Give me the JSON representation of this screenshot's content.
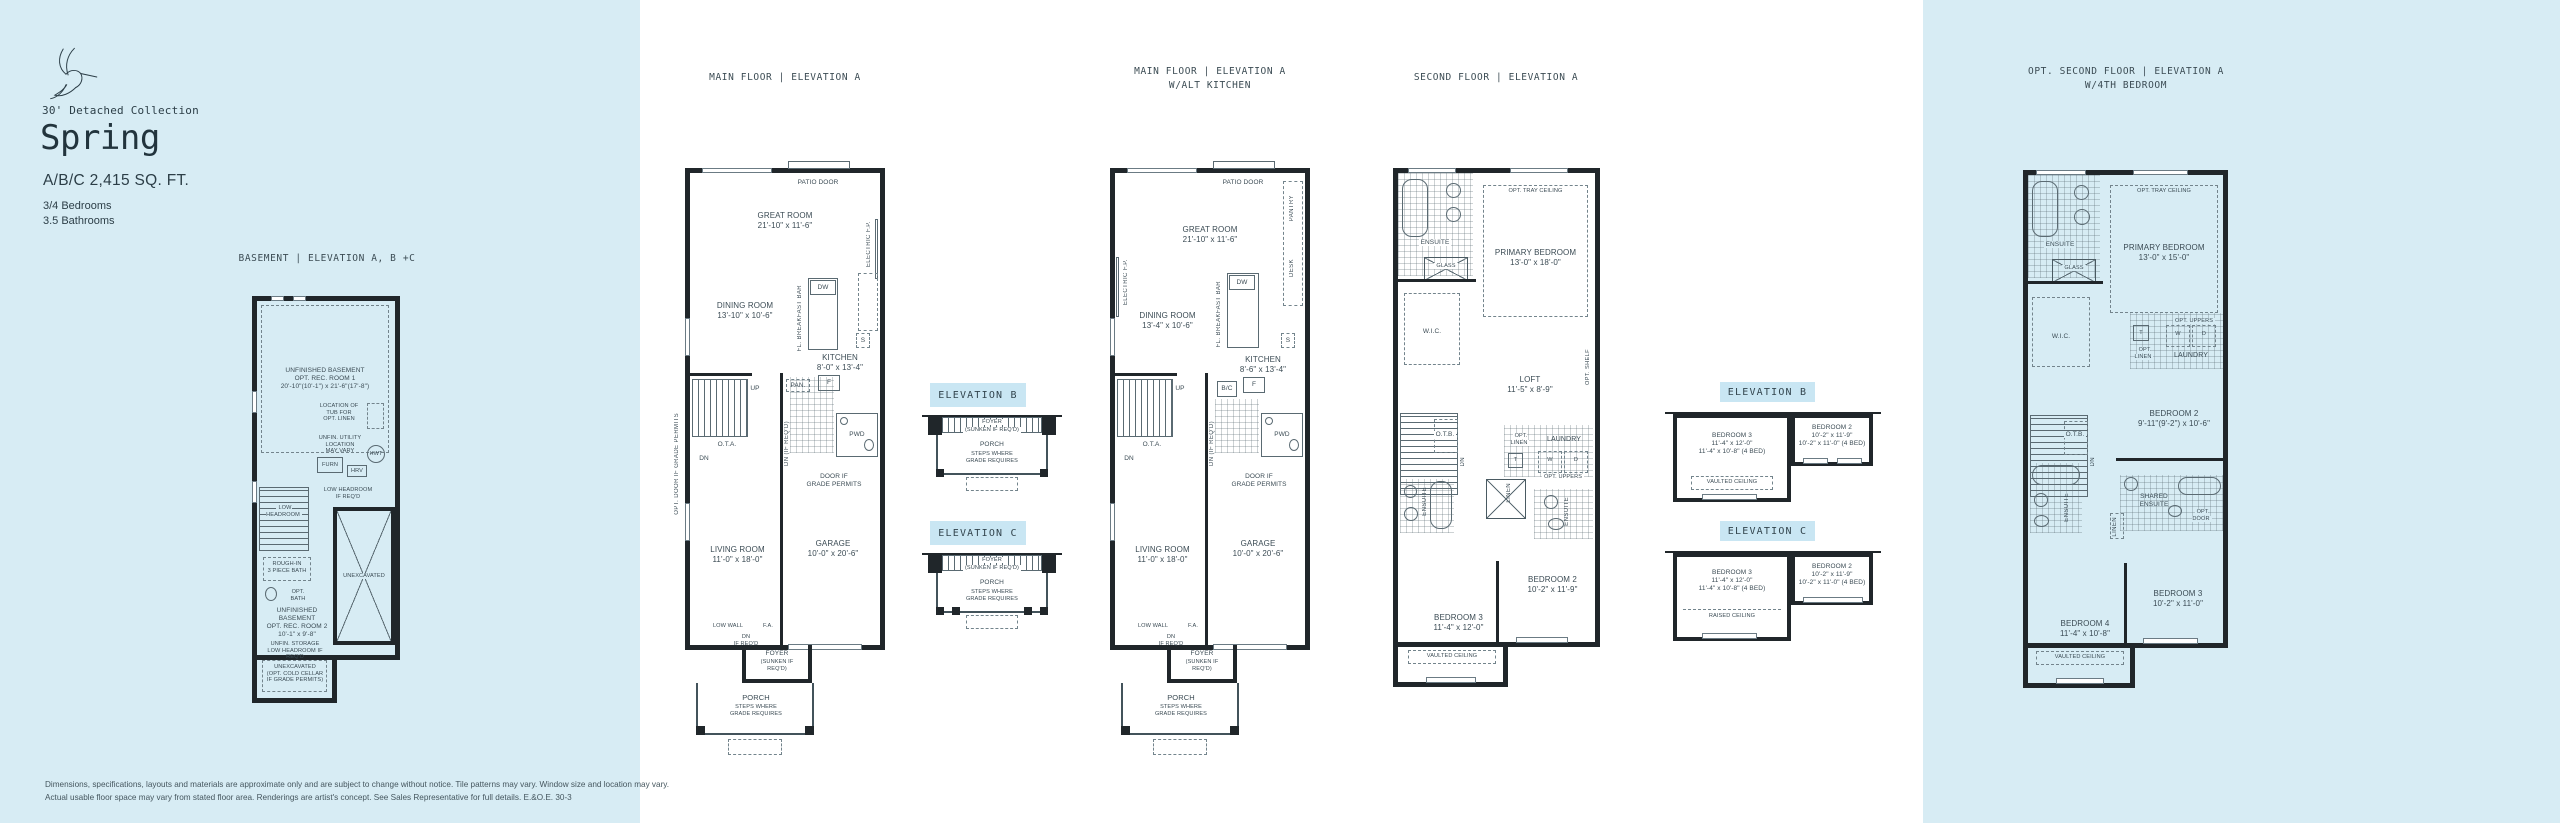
{
  "colors": {
    "panel_blue": "#d7ecf4",
    "badge_blue": "#c9e6f3",
    "wall": "#20262a",
    "line": "#5a6a72",
    "text": "#2c3e47"
  },
  "brand": {
    "collection": "30' Detached Collection",
    "model": "Spring",
    "size": "A/B/C 2,415 SQ. FT.",
    "beds": "3/4 Bedrooms",
    "baths": "3.5 Bathrooms"
  },
  "titles": {
    "basement": "BASEMENT  |  ELEVATION A, B +C",
    "main_a": "MAIN FLOOR  |  ELEVATION A",
    "main_alt_line1": "MAIN FLOOR  |  ELEVATION A",
    "main_alt_line2": "W/ALT KITCHEN",
    "second": "SECOND FLOOR  |  ELEVATION A",
    "opt_line1": "OPT. SECOND FLOOR  |  ELEVATION A",
    "opt_line2": "W/4TH BEDROOM",
    "elev_b": "ELEVATION B",
    "elev_c": "ELEVATION C"
  },
  "basement": {
    "rec1": "UNFINISHED BASEMENT\nOPT. REC. ROOM 1\n20'-10\"(10'-1\") x 21'-6\"(17'-8\")",
    "tub_note": "LOCATION OF\nTUB FOR\nOPT. LINEN",
    "utility": "UNFIN. UTILITY\nLOCATION\nMAY VARY",
    "furn": "FURN",
    "hrv": "HRV",
    "hwt": "HWT",
    "low_headroom_req": "LOW HEADROOM\nIF REQ'D",
    "low_headroom": "LOW HEADROOM",
    "rough_in": "ROUGH-IN\n3 PIECE BATH",
    "opt_bath": "OPT.\nBATH",
    "rec2": "UNFINISHED\nBASEMENT\nOPT. REC. ROOM 2\n10'-1\" x 9'-8\"",
    "unexcavated": "UNEXCAVATED",
    "storage": "UNFIN. STORAGE\nLOW HEADROOM IF REQ'D",
    "cold_cellar": "UNEXCAVATED\n(OPT. COLD CELLAR\nIF GRADE PERMITS)"
  },
  "main_a": {
    "patio_door": "PATIO DOOR",
    "great_room": "GREAT ROOM\n21'-10\" x 11'-6\"",
    "electric_fp": "ELECTRIC F.P.",
    "dining": "DINING ROOM\n13'-10\" x 10'-6\"",
    "breakfast_bar": "FL. BREAKFAST BAR",
    "dw": "DW",
    "kitchen": "KITCHEN\n8'-0\" x 13'-4\"",
    "pan": "PAN.",
    "s": "S",
    "f": "F",
    "ota": "O.T.A.",
    "up": "UP",
    "dn": "DN",
    "pwd": "PWD",
    "dn_if_reqd": "DN (IF REQ'D)",
    "door_grade": "DOOR IF\nGRADE PERMITS",
    "opt_door_grade": "OPT. DOOR IF GRADE PERMITS",
    "living": "LIVING ROOM\n11'-0\" x 18'-0\"",
    "garage": "GARAGE\n10'-0\" x 20'-6\"",
    "low_wall": "LOW WALL",
    "fa": "F.A.",
    "dn_if_reqd2": "DN\nIF REQ'D",
    "foyer": "FOYER",
    "foyer_note": "(SUNKEN IF\nREQ'D)",
    "porch": "PORCH",
    "porch_note": "STEPS WHERE\nGRADE REQUIRES"
  },
  "main_alt": {
    "patio_door": "PATIO DOOR",
    "pantry": "PANTRY",
    "desk": "DESK",
    "great_room": "GREAT ROOM\n21'-10\" x 11'-6\"",
    "electric_fp": "ELECTRIC F.P.",
    "dining": "DINING ROOM\n13'-4\" x 10'-6\"",
    "breakfast_bar": "FL. BREAKFAST BAR",
    "dw": "DW",
    "kitchen": "KITCHEN\n8'-6\" x 13'-4\"",
    "bc": "B/C",
    "f": "F",
    "s": "S",
    "ota": "O.T.A.",
    "up": "UP",
    "dn": "DN",
    "pwd": "PWD",
    "dn_if_reqd": "DN (IF REQ'D)",
    "door_grade": "DOOR IF\nGRADE PERMITS",
    "living": "LIVING ROOM\n11'-0\" x 18'-0\"",
    "garage": "GARAGE\n10'-0\" x 20'-6\"",
    "low_wall": "LOW WALL",
    "fa": "F.A.",
    "dn_if_reqd2": "DN\nIF REQ'D",
    "foyer": "FOYER",
    "foyer_note": "(SUNKEN IF\nREQ'D)",
    "porch": "PORCH",
    "porch_note": "STEPS WHERE\nGRADE REQUIRES"
  },
  "second": {
    "ensuite": "ENSUITE",
    "glass": "GLASS",
    "tray": "OPT. TRAY CEILING",
    "primary": "PRIMARY BEDROOM\n13'-0\" x 18'-0\"",
    "wic": "W.I.C.",
    "loft": "LOFT\n11'-5\" x 8'-9\"",
    "opt_shelf": "OPT. SHELF",
    "otb": "O.T.B.",
    "dn": "DN",
    "opt_linen": "OPT.\nLINEN",
    "laundry": "LAUNDRY",
    "t": "T",
    "w": "W",
    "d": "D",
    "opt_uppers": "OPT. UPPERS",
    "linen": "LINEN",
    "ensuite2": "ENSUITE",
    "bedroom2": "BEDROOM 2\n10'-2\" x 11'-9\"",
    "bedroom3": "BEDROOM 3\n11'-4\" x 12'-0\"",
    "vaulted": "VAULTED CEILING"
  },
  "insets_main": {
    "foyer": "FOYER",
    "foyer_note": "(SUNKEN IF REQ'D)",
    "porch": "PORCH",
    "porch_note": "STEPS WHERE\nGRADE REQUIRES"
  },
  "insets_second": {
    "bedroom3": "BEDROOM 3\n11'-4\" x 12'-0\"\n11'-4\" x 10'-8\" (4 BED)",
    "bedroom2": "BEDROOM 2\n10'-2\" x 11'-9\"\n10'-2\" x 11'-0\" (4 BED)",
    "vaulted": "VAULTED CEILING",
    "raised": "RAISED CEILING"
  },
  "opt_second": {
    "ensuite": "ENSUITE",
    "glass": "GLASS",
    "tray": "OPT. TRAY CEILING",
    "primary": "PRIMARY BEDROOM\n13'-0\" x 15'-0\"",
    "wic": "W.I.C.",
    "opt_uppers": "OPT. UPPERS",
    "t": "T",
    "w": "W",
    "d": "D",
    "opt_linen": "OPT.\nLINEN",
    "laundry": "LAUNDRY",
    "otb": "O.T.B.",
    "dn": "DN",
    "bedroom2": "BEDROOM 2\n9'-11\"(9'-2\") x 10'-6\"",
    "shared_ensuite": "SHARED\nENSUITE",
    "opt_door": "OPT.\nDOOR",
    "linen": "LINEN",
    "ensuite2": "ENSUITE",
    "bedroom3": "BEDROOM 3\n10'-2\" x 11'-0\"",
    "bedroom4": "BEDROOM 4\n11'-4\" x 10'-8\"",
    "vaulted": "VAULTED CEILING"
  },
  "footer": {
    "line1": "Dimensions, specifications, layouts and materials are approximate only and are subject to change without notice. Tile patterns may vary. Window size and location may vary.",
    "line2": "Actual usable floor space may vary from stated floor area. Renderings are artist's concept. See Sales Representative for full details. E.&O.E.  30-3"
  }
}
